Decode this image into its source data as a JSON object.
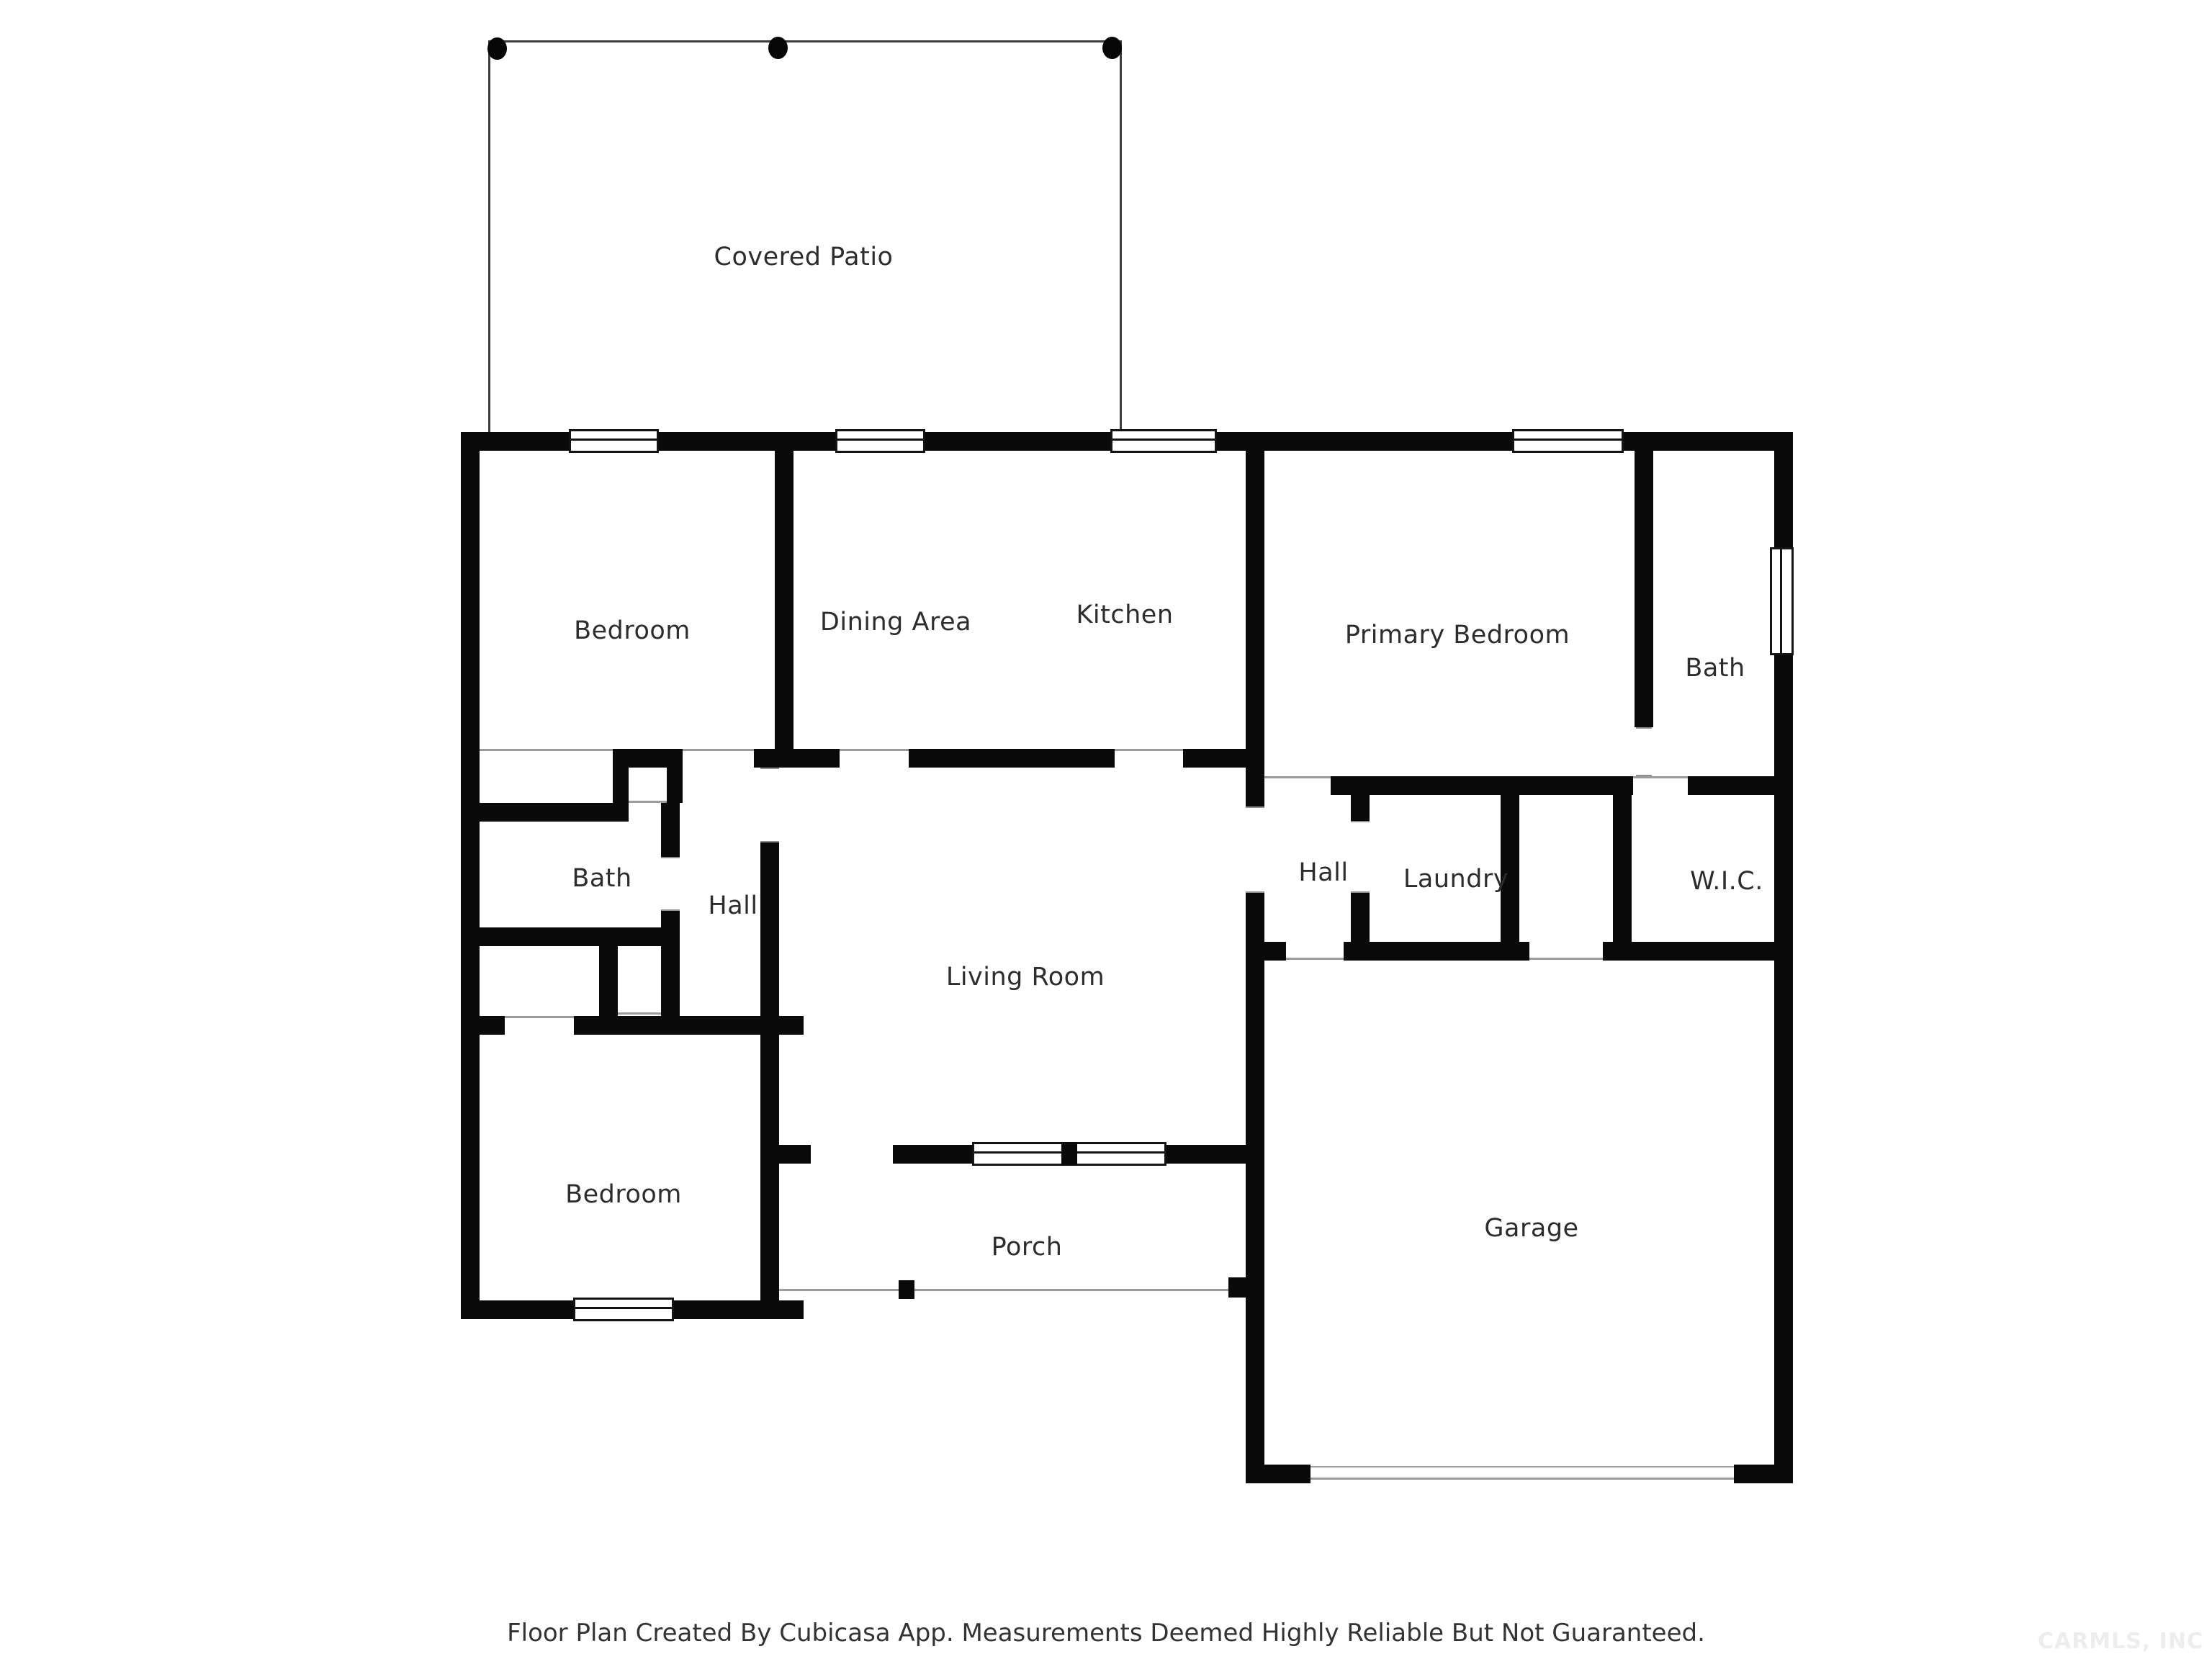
{
  "rooms": [
    {
      "id": "covered-patio",
      "label": "Covered Patio"
    },
    {
      "id": "bedroom-top",
      "label": "Bedroom"
    },
    {
      "id": "dining-area",
      "label": "Dining Area"
    },
    {
      "id": "kitchen",
      "label": "Kitchen"
    },
    {
      "id": "primary-bedroom",
      "label": "Primary Bedroom"
    },
    {
      "id": "bath-right",
      "label": "Bath"
    },
    {
      "id": "bath-left",
      "label": "Bath"
    },
    {
      "id": "hall-left",
      "label": "Hall"
    },
    {
      "id": "hall-right",
      "label": "Hall"
    },
    {
      "id": "laundry",
      "label": "Laundry"
    },
    {
      "id": "wic",
      "label": "W.I.C."
    },
    {
      "id": "living-room",
      "label": "Living Room"
    },
    {
      "id": "bedroom-bottom",
      "label": "Bedroom"
    },
    {
      "id": "porch",
      "label": "Porch"
    },
    {
      "id": "garage",
      "label": "Garage"
    }
  ],
  "footer": {
    "text": "Floor Plan Created By Cubicasa App. Measurements Deemed Highly Reliable But Not Guaranteed."
  },
  "watermark": {
    "text": "CARMLS, INC"
  },
  "colors": {
    "wall": "#0a0a0a",
    "opening_line": "#9b9b9b",
    "patio_outline": "#3d3d3d",
    "label_text": "#2d2d2d",
    "watermark_text": "#ededed"
  }
}
